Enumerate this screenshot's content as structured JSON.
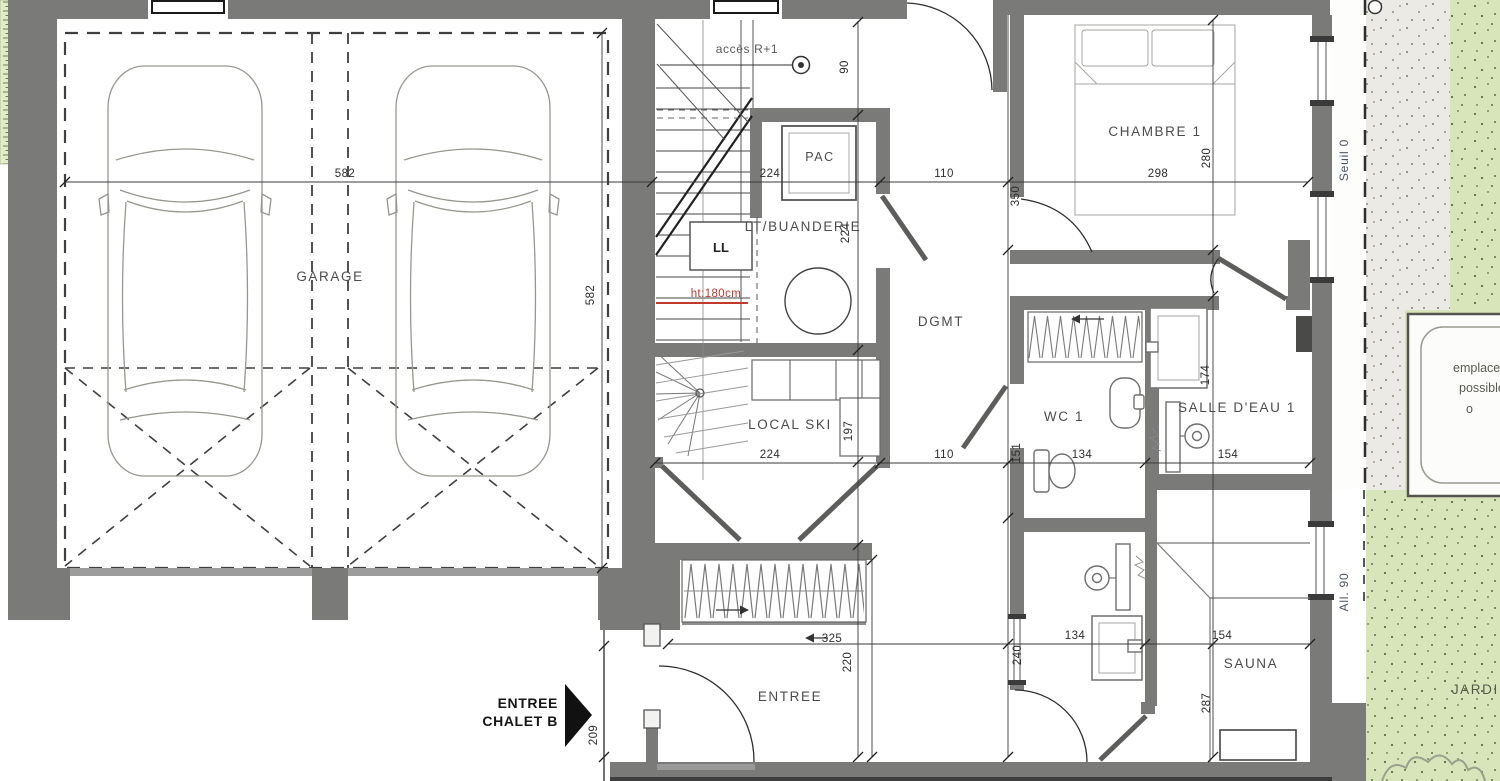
{
  "plan_title": "Chalet B - niveau 0 (plan de masse)",
  "rooms": {
    "garage": "GARAGE",
    "chambre1": "CHAMBRE 1",
    "dgmt": "DGMT",
    "wc1": "WC 1",
    "salle_deau1": "SALLE D'EAU 1",
    "sauna": "SAUNA",
    "entree": "ENTREE",
    "local_ski": "LOCAL SKI",
    "lt_buanderie": "LT/BUANDERIE",
    "pac": "PAC",
    "ll": "LL",
    "jardin": "JARDIN"
  },
  "annotations": {
    "acces_r1": "accès R+1",
    "ht180": "ht:180cm",
    "seuil0": "Seuil 0",
    "all90": "All. 90",
    "entree_arrow_line1": "ENTREE",
    "entree_arrow_line2": "CHALET B",
    "emplacement_line1": "emplacement",
    "emplacement_line2": "possible",
    "emplacement_line3": "o"
  },
  "dimensions": {
    "garage_width": "582",
    "garage_depth": "582",
    "stair_width": "224",
    "buanderie_depth": "224",
    "local_ski_width": "224",
    "stair_top": "90",
    "hall_top": "110",
    "hall_bottom": "110",
    "chambre_width": "298",
    "chambre_depth": "280",
    "hall_height": "350",
    "local_ski_depth": "197",
    "wc_depth": "151",
    "wc_width": "134",
    "sde_width": "154",
    "sde_depth": "174",
    "bath_width": "134",
    "bath_depth": "240",
    "sauna_width": "154",
    "sauna_depth": "287",
    "entree_width": "325",
    "entree_depth": "220",
    "entree_door": "209"
  },
  "colors": {
    "wall_gray": "#7a7a78",
    "terrain_green": "#d8e4ba",
    "path_gray": "#eceae4",
    "dim_red": "#c0392b",
    "annotation_blue": "#4a5568"
  }
}
